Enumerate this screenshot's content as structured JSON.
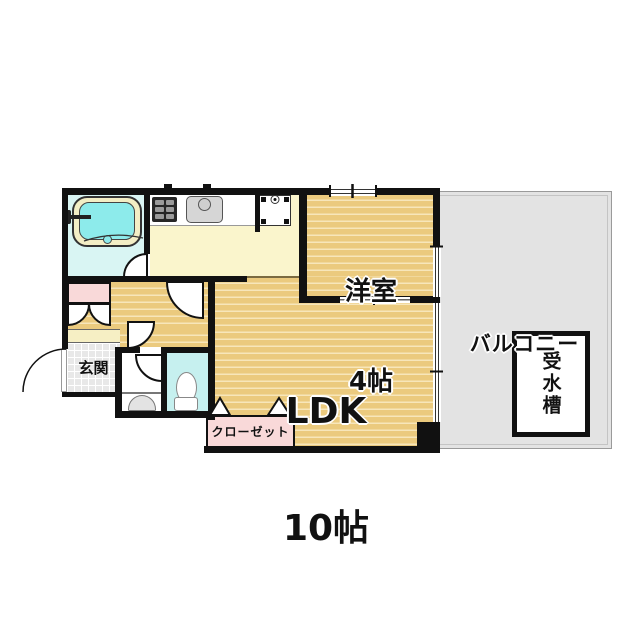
{
  "labels": {
    "balcony": "バルコニー",
    "water_tank": "受水槽",
    "yoshitsu_name": "洋室",
    "yoshitsu_size": "4帖",
    "ldk_name": "LDK",
    "ldk_size": "10帖",
    "genkan": "玄関",
    "closet": "クローゼット"
  },
  "colors": {
    "wall": "#111111",
    "wood_floor": "#ebca7e",
    "wood_stripe": "#f7e6ba",
    "kitchen_floor": "#faf5cc",
    "bathroom_floor": "#d9f5f3",
    "toilet_floor": "#c6f0ef",
    "balcony_floor": "#e3e3e3",
    "closet_pink": "#f9d9d9",
    "tub_rim": "#f3eec5",
    "tub_water": "#8debeb",
    "tile_gray": "#e8e8e8"
  }
}
